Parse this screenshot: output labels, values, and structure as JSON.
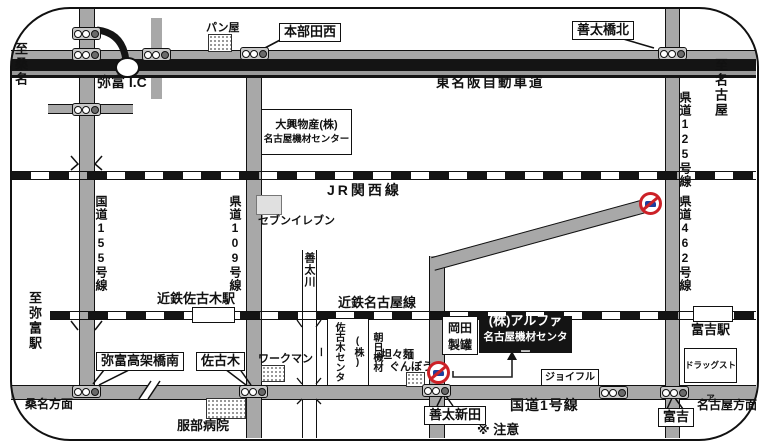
{
  "accent_colors": {
    "road_gray": "#a8a8a8",
    "expressway_black": "#141414",
    "sign_red": "#cc2127",
    "car_blue": "#1c3f9e",
    "destination_bg": "#141414"
  },
  "edges": {
    "to_kuwana": "至桑名",
    "to_nagoya": "至名古屋",
    "to_yatomi_station": "至弥富駅",
    "kuwana_direction": "桑名方面",
    "nagoya_direction": "名古屋方面"
  },
  "roads": {
    "expressway": "東名阪自動車道",
    "ic": "弥富 I.C",
    "route1": "国道1号線",
    "route155": "国道155号線",
    "pref109": "県道109号線",
    "pref125": "県道125号線",
    "pref462": "県道462号線"
  },
  "railways": {
    "jr": "JR関西線",
    "kintetsu": "近鉄名古屋線",
    "sakogi_station": "近鉄佐古木駅",
    "tomiyoshi_station": "富吉駅"
  },
  "river": {
    "name": "善太川"
  },
  "intersections": {
    "honbuda_nishi": "本部田西",
    "zentabashi_kita": "善太橋北",
    "yatomi_kokakyo_minami": "弥富高架橋南",
    "sakogi": "佐古木",
    "zenta_shinden": "善太新田",
    "tomiyoshi": "富吉",
    "caution": "※ 注意"
  },
  "places": {
    "bakery": "パン屋",
    "daiko_line1": "大興物産(株)",
    "daiko_line2": "名古屋機材センター",
    "seven_eleven": "セブンイレブン",
    "workman": "ワークマン",
    "asahi": "朝日機材(株)\n佐古木センター",
    "tantan_line1": "坦々麺",
    "tantan_line2": "ぐんぼう",
    "okada_line1": "岡田",
    "okada_line2": "製罐",
    "alpha_line1": "(株)アルファ",
    "alpha_line2": "名古屋機材センター",
    "joyful": "ジョイフル",
    "drugstore": "ドラッグストア",
    "hattori": "服部病院"
  }
}
